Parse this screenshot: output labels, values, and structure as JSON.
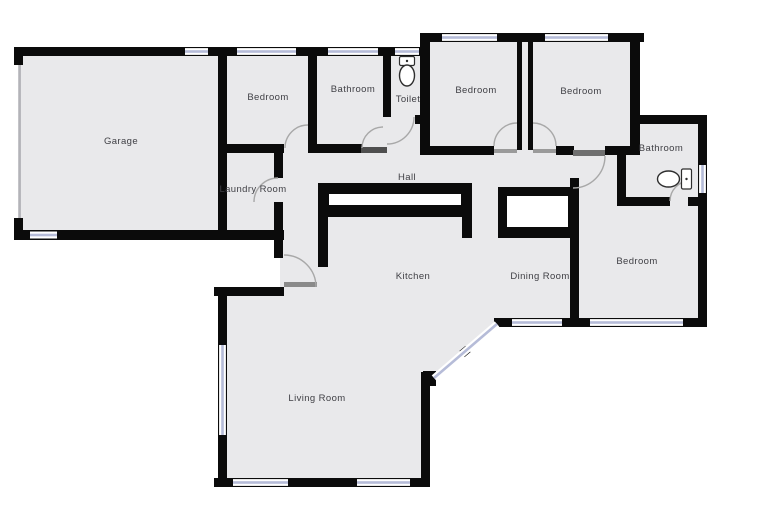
{
  "page": {
    "type": "floor-plan",
    "background": "#ffffff"
  },
  "colors": {
    "floor_fill": "#e9e9eb",
    "wall": "#0b0b0b",
    "window_line": "#b6bcd8",
    "door_arc": "#a8a8a8",
    "threshold_dark": "#4f4f4f",
    "threshold_mid": "#8a8a8a",
    "label_text": "#3f3f44",
    "fixture_stroke": "#2e2e2e",
    "garage_door_line": "#b3b3b8"
  },
  "rooms": [
    {
      "id": "garage",
      "label": "Garage"
    },
    {
      "id": "bedroom-top-left",
      "label": "Bedroom"
    },
    {
      "id": "bathroom-top",
      "label": "Bathroom"
    },
    {
      "id": "toilet-room",
      "label": "Toilet"
    },
    {
      "id": "bedroom-top-middle",
      "label": "Bedroom"
    },
    {
      "id": "bedroom-top-right",
      "label": "Bedroom"
    },
    {
      "id": "bathroom-right",
      "label": "Bathroom"
    },
    {
      "id": "laundry-room",
      "label": "Laundry Room"
    },
    {
      "id": "hall",
      "label": "Hall"
    },
    {
      "id": "kitchen",
      "label": "Kitchen"
    },
    {
      "id": "dining-room",
      "label": "Dining Room"
    },
    {
      "id": "bedroom-right",
      "label": "Bedroom"
    },
    {
      "id": "living-room",
      "label": "Living Room"
    }
  ],
  "fixtures": [
    {
      "name": "toilet",
      "location": "toilet-room"
    },
    {
      "name": "toilet",
      "location": "bathroom-right"
    }
  ]
}
